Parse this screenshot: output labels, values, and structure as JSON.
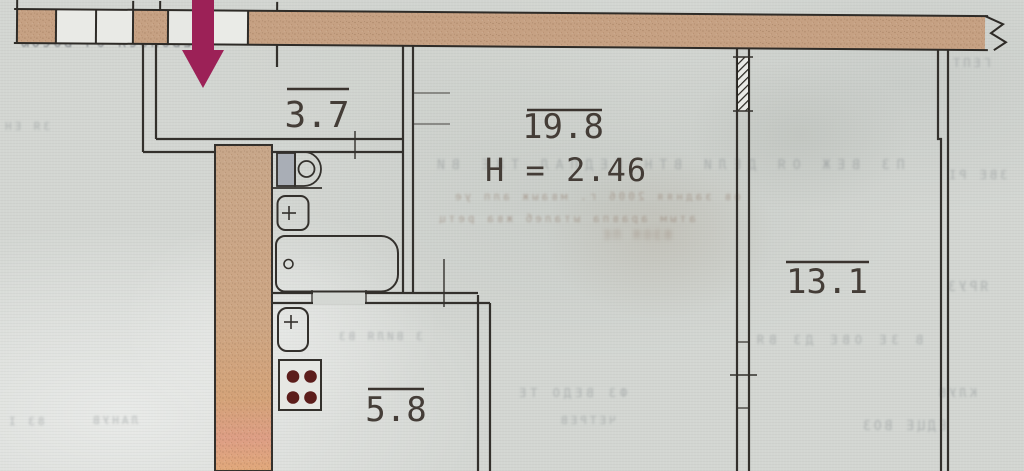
{
  "plan": {
    "rooms": [
      {
        "name": "hallway",
        "area": "3.7"
      },
      {
        "name": "living-room",
        "area": "19.8",
        "height": "H = 2.46"
      },
      {
        "name": "kitchen",
        "area": "5.8"
      },
      {
        "name": "room-2",
        "area": "13.1"
      }
    ],
    "fixtures": [
      "entrance-arrow",
      "toilet",
      "wash-basin",
      "bathtub",
      "kitchen-sink",
      "stove"
    ]
  },
  "colors": {
    "arrow": "#9c2157",
    "wall_fill": "#c6a183",
    "line": "#33302c",
    "paper": "#d3d6d2",
    "burner": "#5c1d1b",
    "label": "#3a322c",
    "height_label": "#5d352c"
  },
  "bleedthrough": [
    {
      "text": "ЕВОНОСЯ ОЧ ВОСОЮ"
    },
    {
      "text": "ІЯ ВЗ ЯМ ЕЖЗЫ ВЧАСЕ"
    },
    {
      "text": "ЗЯ ЕН"
    },
    {
      "text": "ПЗ ВЕЖ ОЯ ДЕЛИ ВТН ГЕДПАЛ ТЖЕ ВИ"
    },
    {
      "text": "ов задняя 2006 г. мваыж алп уе"
    },
    {
      "text": "атым аравпа ыталеб жва ретц"
    },
    {
      "text": "ГЕПТ"
    },
    {
      "text": "ЗВЕ РІ"
    },
    {
      "text": "ЯРУЗ"
    },
    {
      "text": "В ЗЕ ОВЕ ДЗ ВЯ"
    },
    {
      "text": "КЛУВ"
    },
    {
      "text": "ЕДЦЕ ВОЗ"
    },
    {
      "text": "ФЗ ВЕДО ТЕ"
    },
    {
      "text": "ЧЕТРЕВ"
    },
    {
      "text": "83 І"
    },
    {
      "text": "ЛАНУВ"
    },
    {
      "text": "З ВИЛЯ ВЗ"
    },
    {
      "text": "ВЗОЯ ПЕ"
    }
  ]
}
